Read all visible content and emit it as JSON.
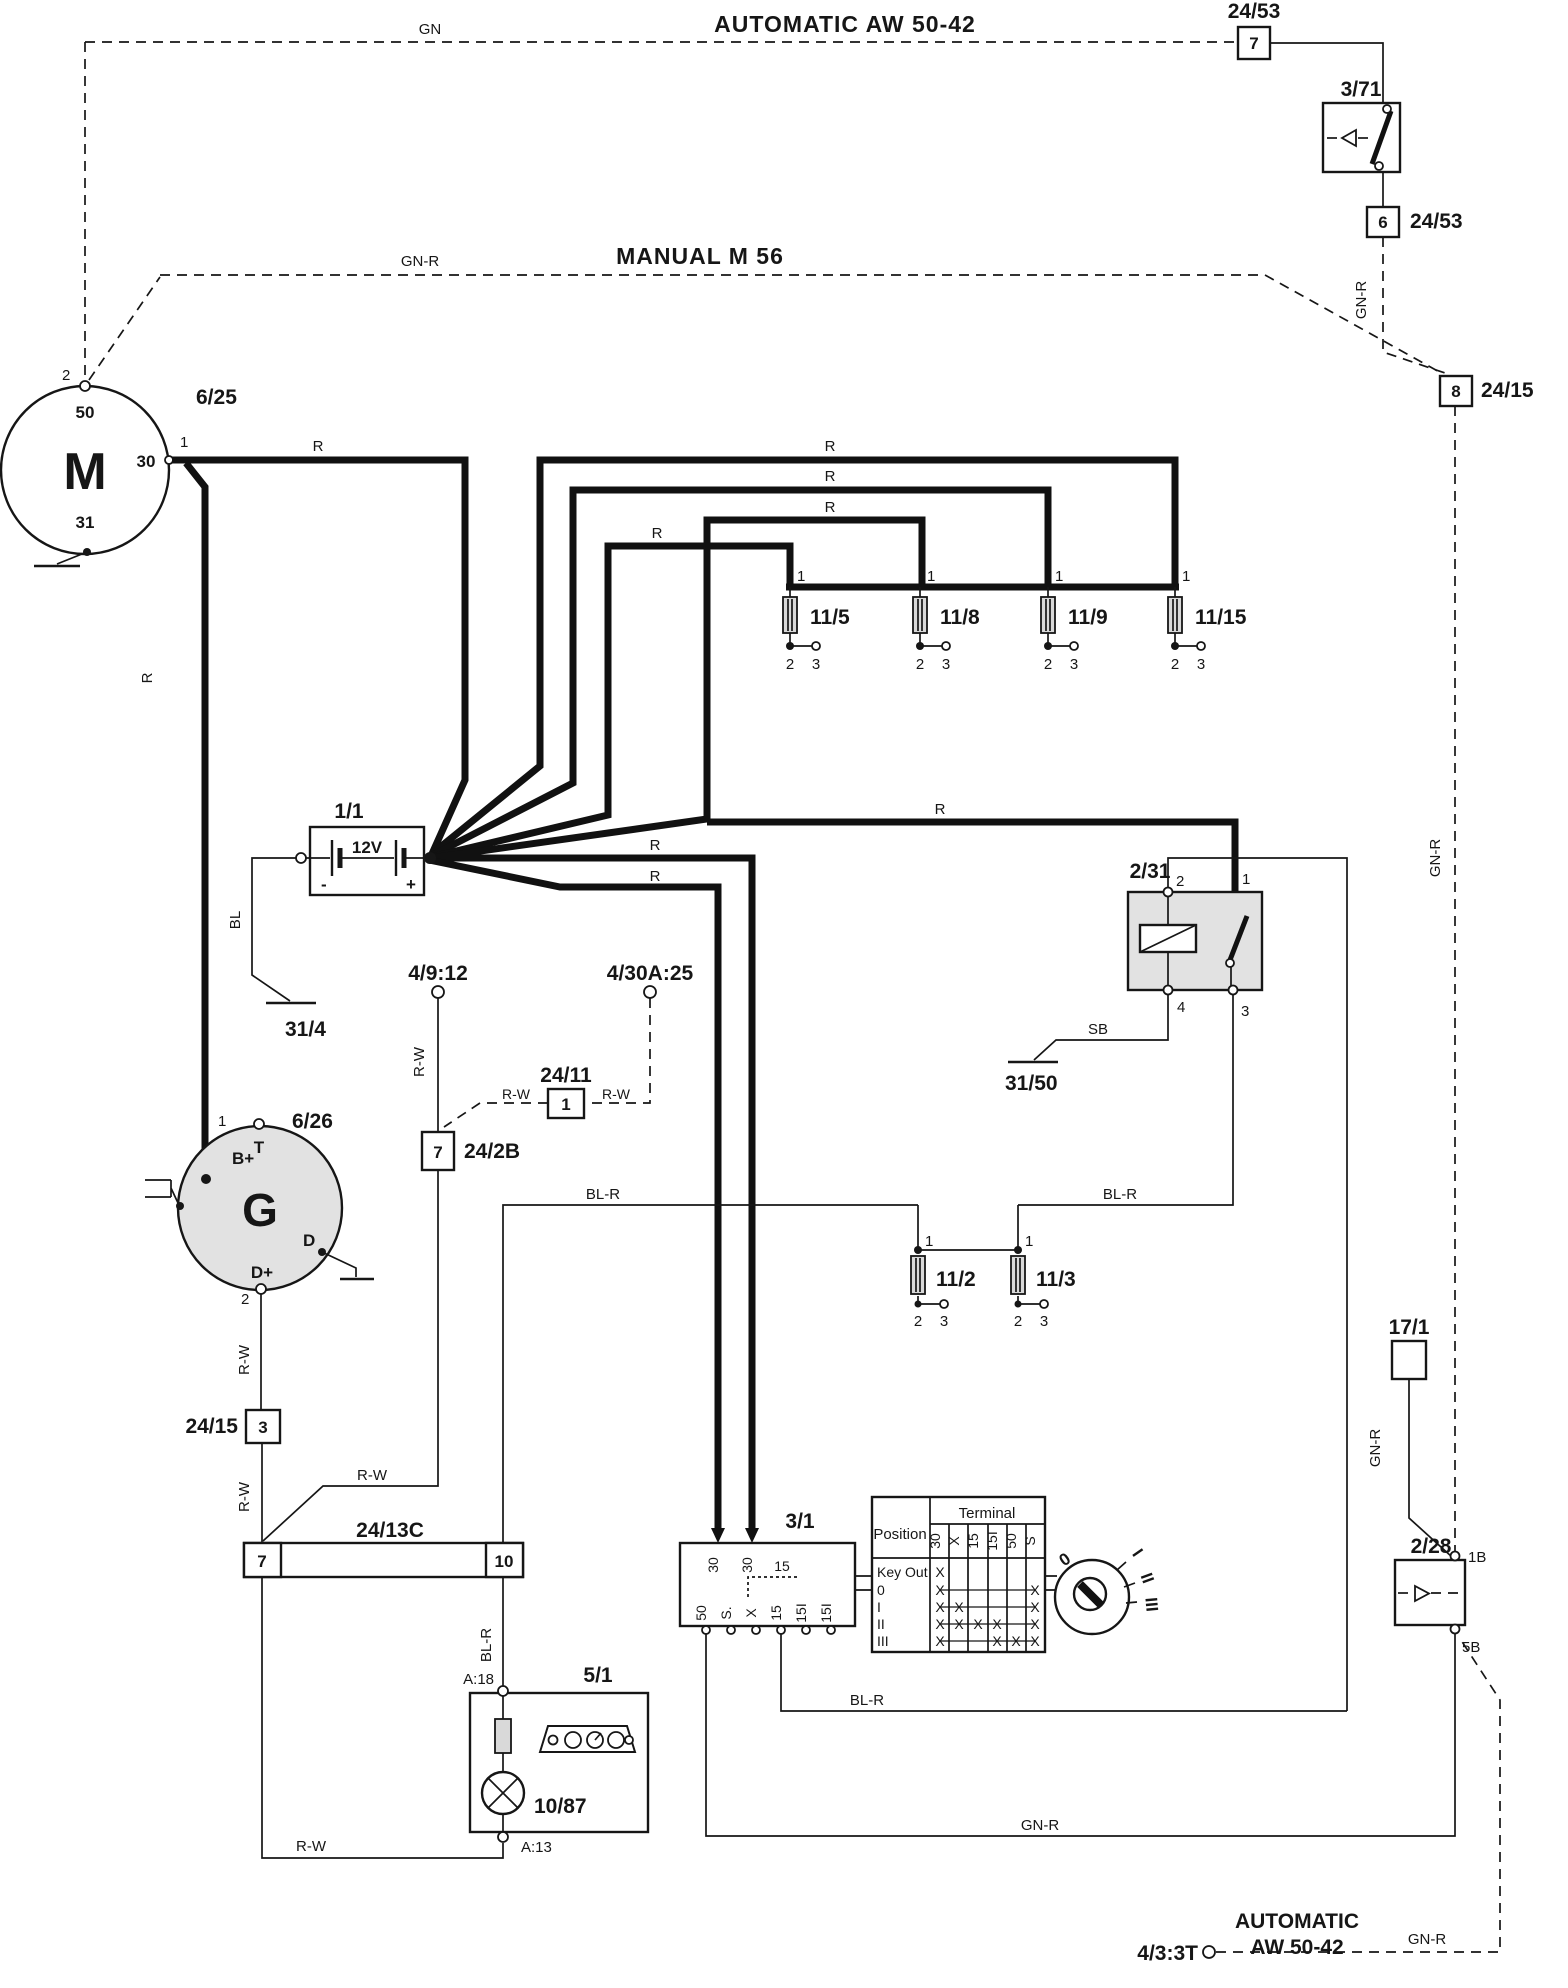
{
  "titles": {
    "automatic_top": "AUTOMATIC  AW 50-42",
    "manual": "MANUAL  M 56",
    "automatic_bottom_line1": "AUTOMATIC",
    "automatic_bottom_line2": "AW 50-42"
  },
  "wire_colors": {
    "gn": "GN",
    "gn_r": "GN-R",
    "r": "R",
    "bl": "BL",
    "bl_r": "BL-R",
    "r_w": "R-W",
    "sb": "SB"
  },
  "pins": {
    "p1": "1",
    "p2": "2",
    "p3": "3",
    "p4": "4",
    "p6": "6",
    "p7": "7",
    "p8": "8",
    "p10": "10"
  },
  "components": {
    "connector_24_53": {
      "id": "24/53"
    },
    "inhibitor_switch_3_71": {
      "id": "3/71"
    },
    "connector_24_15": {
      "id": "24/15"
    },
    "starter_motor": {
      "id": "6/25",
      "symbol": "M",
      "pin_50": "50",
      "pin_30": "30",
      "pin_31": "31"
    },
    "battery": {
      "id": "1/1",
      "voltage": "12V",
      "minus": "-",
      "plus": "+"
    },
    "ground_31_4": {
      "id": "31/4"
    },
    "ground_31_50": {
      "id": "31/50"
    },
    "fuse_11_5": {
      "id": "11/5"
    },
    "fuse_11_8": {
      "id": "11/8"
    },
    "fuse_11_9": {
      "id": "11/9"
    },
    "fuse_11_15": {
      "id": "11/15"
    },
    "fuse_11_2": {
      "id": "11/2"
    },
    "fuse_11_3": {
      "id": "11/3"
    },
    "starter_relay_2_31": {
      "id": "2/31"
    },
    "generator": {
      "id": "6/26",
      "symbol": "G",
      "pin_b": "B+",
      "pin_t": "T",
      "pin_d": "D",
      "pin_dplus": "D+"
    },
    "conn_4_9_12": {
      "id": "4/9:12"
    },
    "conn_4_30a_25": {
      "id": "4/30A:25"
    },
    "conn_24_11": {
      "id": "24/11"
    },
    "conn_24_2b": {
      "id": "24/2B"
    },
    "conn_24_13c": {
      "id": "24/13C"
    },
    "ignition_switch": {
      "id": "3/1",
      "t30": "30",
      "t50": "50",
      "ts": "S.",
      "tx": "X",
      "t15": "15",
      "t15i": "15I"
    },
    "cluster_5_1": {
      "id": "5/1",
      "lamp": "10/87",
      "pin_a18": "A:18",
      "pin_a13": "A:13"
    },
    "module_17_1": {
      "id": "17/1"
    },
    "diode_2_28": {
      "id": "2/28",
      "pin_1b": "1B",
      "pin_5b": "5B"
    },
    "conn_4_3_3t": {
      "id": "4/3:3T"
    }
  },
  "ignition_table": {
    "header_position": "Position",
    "header_terminal": "Terminal",
    "columns": [
      "30",
      "X",
      "15",
      "15I",
      "50",
      "S"
    ],
    "mark": "X",
    "rows": [
      {
        "label": "Key Out",
        "marks": [
          1,
          0,
          0,
          0,
          0,
          0
        ]
      },
      {
        "label": "0",
        "marks": [
          1,
          0,
          0,
          0,
          0,
          1
        ]
      },
      {
        "label": "I",
        "marks": [
          1,
          1,
          0,
          0,
          0,
          1
        ]
      },
      {
        "label": "II",
        "marks": [
          1,
          1,
          1,
          1,
          0,
          1
        ]
      },
      {
        "label": "III",
        "marks": [
          1,
          0,
          0,
          1,
          1,
          1
        ]
      }
    ]
  },
  "key_positions": [
    "0",
    "I",
    "II",
    "III"
  ]
}
